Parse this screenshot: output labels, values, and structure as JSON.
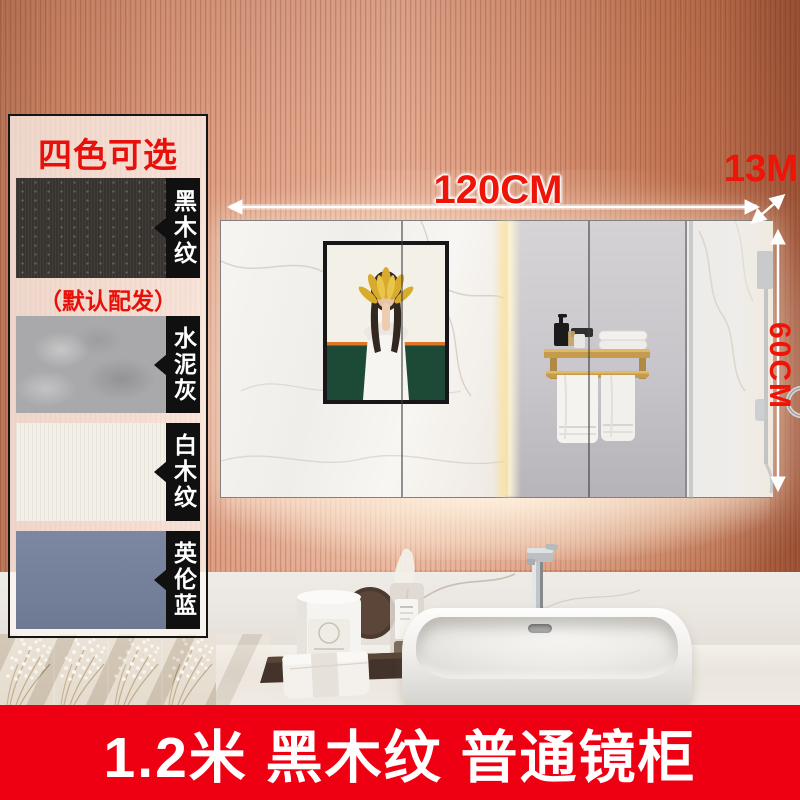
{
  "panel": {
    "title": "四色可选",
    "note": "（默认配发）",
    "swatches": [
      {
        "label": "黑木纹",
        "name": "black-wood-grain",
        "color": "#37332e"
      },
      {
        "label": "水泥灰",
        "name": "cement-gray",
        "color": "#a9a9ab"
      },
      {
        "label": "白木纹",
        "name": "white-wood-grain",
        "color": "#f3f0ea"
      },
      {
        "label": "英伦蓝",
        "name": "british-blue",
        "color": "#76819b"
      }
    ]
  },
  "dimensions": {
    "width_label": "120CM",
    "depth_label": "13M",
    "height_label": "60CM"
  },
  "banner": {
    "text": "1.2米 黑木纹 普通镜柜",
    "background": "#ee0012"
  },
  "colors": {
    "accent_red": "#ef1408",
    "wall_terracotta": "#d99579",
    "gold_hardware": "#c9a35c",
    "mirror_gray": "#c9c7cb",
    "marble_white": "#f4f2ef"
  },
  "icons": {
    "width_arrow": "double-headed horizontal arrow",
    "depth_arrow": "double-headed diagonal arrow",
    "height_arrow": "double-headed vertical arrow"
  }
}
